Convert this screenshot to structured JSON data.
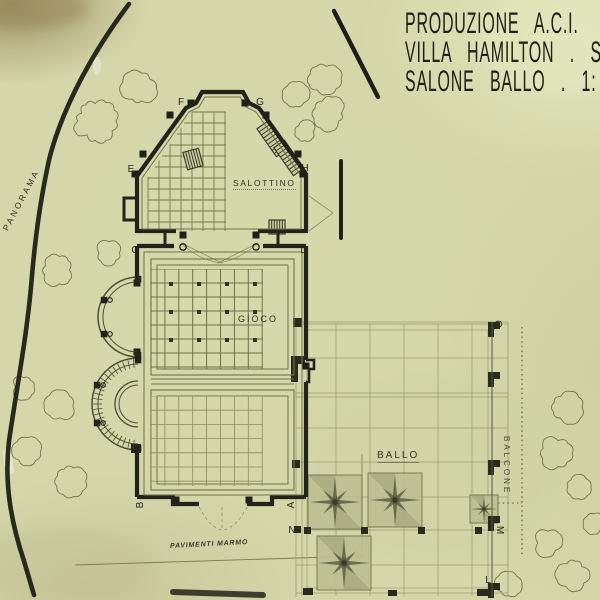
{
  "title_block": {
    "line1": "PRODUZIONE A.C.I.",
    "line2": "VILLA HAMILTON . S",
    "line3": "SALONE BALLO . 1:"
  },
  "rooms": {
    "salottino": "SALOTTINO",
    "gioco": "GIOCO",
    "ballo": "BALLO"
  },
  "annotations": {
    "panorama": "PANORAMA",
    "balcone": "BALCONE",
    "pavimenti_marmo": "PAVIMENTI  MARMO"
  },
  "reference_letters": [
    {
      "char": "F"
    },
    {
      "char": "G"
    },
    {
      "char": "E"
    },
    {
      "char": "H"
    },
    {
      "char": "C"
    },
    {
      "char": "D"
    },
    {
      "char": "B"
    },
    {
      "char": "A"
    },
    {
      "char": "N"
    },
    {
      "char": "O"
    },
    {
      "char": "M"
    },
    {
      "char": "L"
    }
  ],
  "colors": {
    "paper": "#d5d7ab",
    "ink": "#23231a",
    "pencil": "#6f7149",
    "pencil_light": "#9a9c70"
  }
}
